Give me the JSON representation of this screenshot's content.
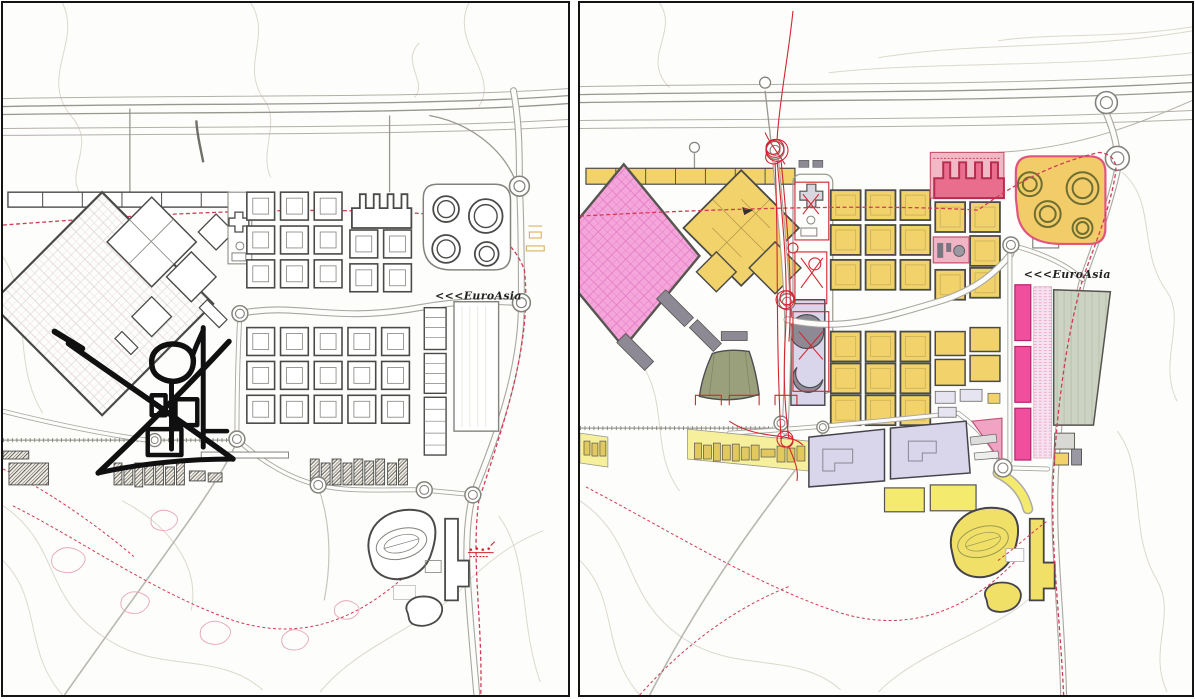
{
  "labels": {
    "left_euroasia": "<<<EuroAsia",
    "right_euroasia": "<<<EuroAsia"
  },
  "palette": {
    "paper": "#fdfdfb",
    "panel_border": "#141414",
    "contour": "#dcd8cc",
    "outline_dark": "#4a4a48",
    "outline_mid": "#84827c",
    "marker": "#101010",
    "dash_red": "#cf3c55",
    "pen_red": "#d12630",
    "pink": "#f4a6db",
    "yellow": "#f2d36b",
    "pale_yellow": "#f6ef9b",
    "magenta": "#e96e8e",
    "magenta_outline": "#b52d4d",
    "hot_pink": "#f04f9e",
    "orange_yellow": "#f2cc69",
    "lavender": "#d9d5ea",
    "olive": "#9ba07c",
    "gray_building": "#8d8a96",
    "green_gray": "#cdd3c3",
    "tank_ring": "#6e6e32"
  }
}
